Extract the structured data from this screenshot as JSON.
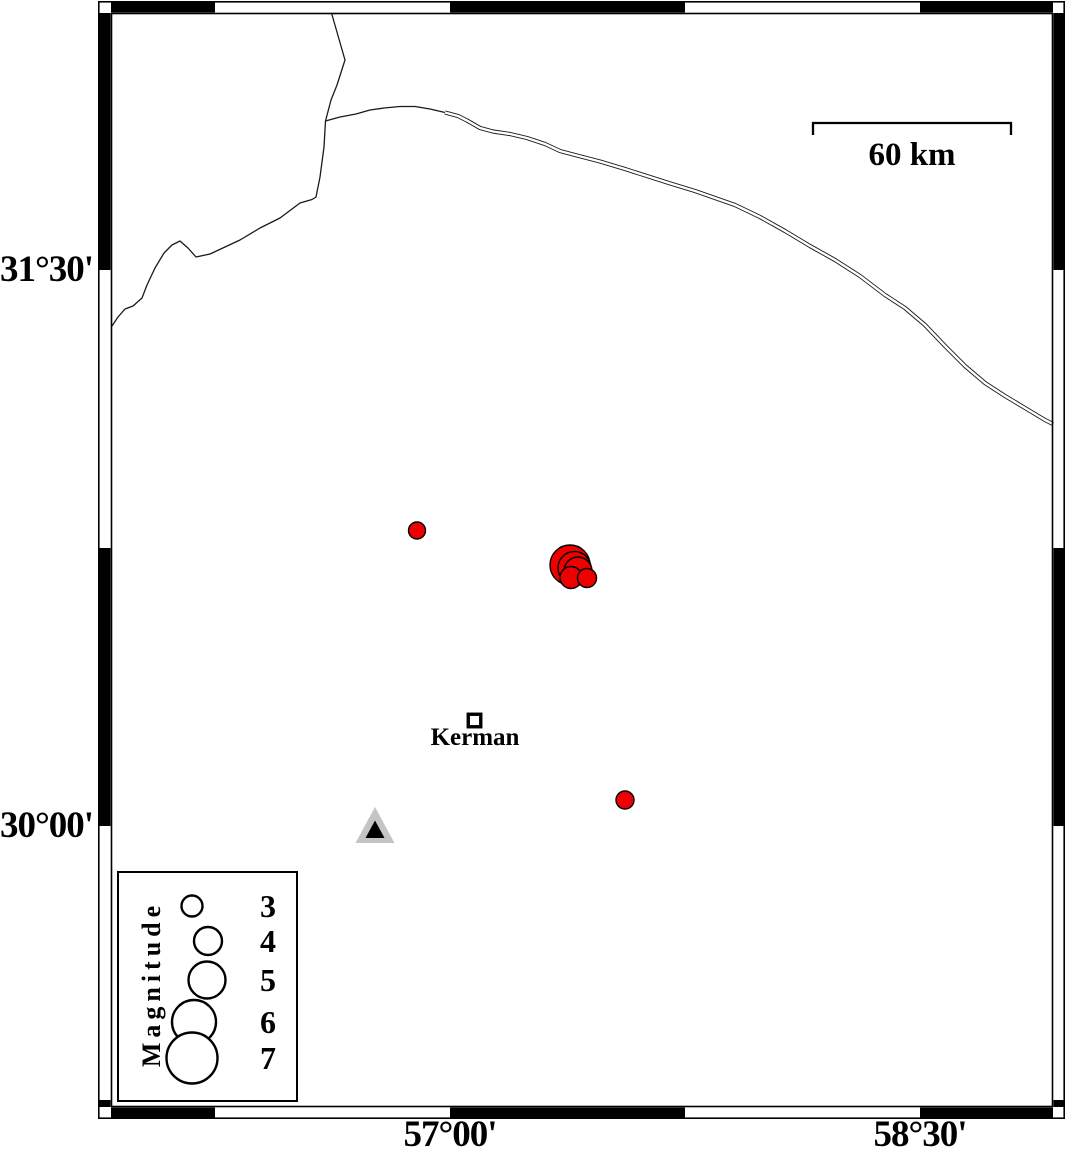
{
  "colors": {
    "earthquake_fill": "#ee0000",
    "outline": "#000000",
    "station_fill": "#c4c4c4",
    "road": "#1a1a1a",
    "frame": "#000000"
  },
  "axes": {
    "left_labels": [
      {
        "text": "31°30'",
        "y": 270
      },
      {
        "text": "30°00'",
        "y": 826
      }
    ],
    "bottom_labels": [
      {
        "text": "57°00'",
        "x": 450
      },
      {
        "text": "58°30'",
        "x": 920
      }
    ]
  },
  "frame": {
    "outer": {
      "x1": 98,
      "y1": 1,
      "x2": 1065,
      "y2": 1119
    },
    "inner": {
      "x1": 111,
      "y1": 13,
      "x2": 1053,
      "y2": 1107
    },
    "horizontal_black_segments": [
      [
        111,
        215
      ],
      [
        450,
        685
      ],
      [
        920,
        1053
      ]
    ],
    "vertical_black_segments": [
      [
        13,
        270
      ],
      [
        548,
        826
      ],
      [
        1100,
        1107
      ]
    ]
  },
  "scale_bar": {
    "label": "60 km",
    "x1": 813,
    "x2": 1011,
    "y": 123,
    "tick_height": 12
  },
  "city": {
    "label": "Kerman",
    "x": 474.5,
    "y": 720.5,
    "marker_size": 12.5
  },
  "station_triangle": {
    "outer_points": "375,807 355.5,843 394.5,843",
    "inner_points": "375,820.5 365.5,838 384.5,838"
  },
  "earthquakes": [
    {
      "x": 417,
      "y": 530.5,
      "r": 8.5
    },
    {
      "x": 570,
      "y": 565,
      "r": 20
    },
    {
      "x": 574.5,
      "y": 568,
      "r": 16.5
    },
    {
      "x": 578,
      "y": 571,
      "r": 14
    },
    {
      "x": 571,
      "y": 577.5,
      "r": 11
    },
    {
      "x": 587,
      "y": 578,
      "r": 9.5
    },
    {
      "x": 625,
      "y": 800,
      "r": 9
    }
  ],
  "legend": {
    "title": "Magnitude",
    "box": {
      "x1": 118,
      "y1": 872,
      "x2": 297,
      "y2": 1101
    },
    "entries": [
      {
        "label": "3",
        "cx": 192,
        "cy": 906,
        "r": 10.5
      },
      {
        "label": "4",
        "cx": 208,
        "cy": 941,
        "r": 14
      },
      {
        "label": "5",
        "cx": 207,
        "cy": 980,
        "r": 18.5
      },
      {
        "label": "6",
        "cx": 194,
        "cy": 1022,
        "r": 22
      },
      {
        "label": "7",
        "cx": 192,
        "cy": 1058,
        "r": 25.5
      }
    ]
  },
  "roads": {
    "boundary_line": "M331.5,13 L345,60 L337,85 L331,100 L325.5,121 L324,147 L320,177 L316,197 L312,199.5 L300,203 L280,218 L260,228 L240,240 L225,247 L210,254 L196,257 L188,248 L180,241 L172,245 L164,253 L155,268 L147,285 L142,298 L133,306 L125,309 L118,317 L112,326",
    "road_single": "M325.5,121 L340,117 L356,114 L370,110 L384,108 L400,106.5 L415,106.5 L430,109 L445,112.5",
    "road_double": "M445,112.5 L458,116 L467,120.5 L480,128 L493,131.5 L510,134 L527,138 L545,144 L560,151 L575,155 L600,161.5 L625,169 L650,177 L672,184 L695,191 L715,198 L735,205 L760,217 L785,231 L810,246 L835,260 L860,276 L885,295 L905,308 L925,325 L945,346 L965,366 L985,383 L1005,396 L1025,408 L1045,420 L1053,424"
  }
}
